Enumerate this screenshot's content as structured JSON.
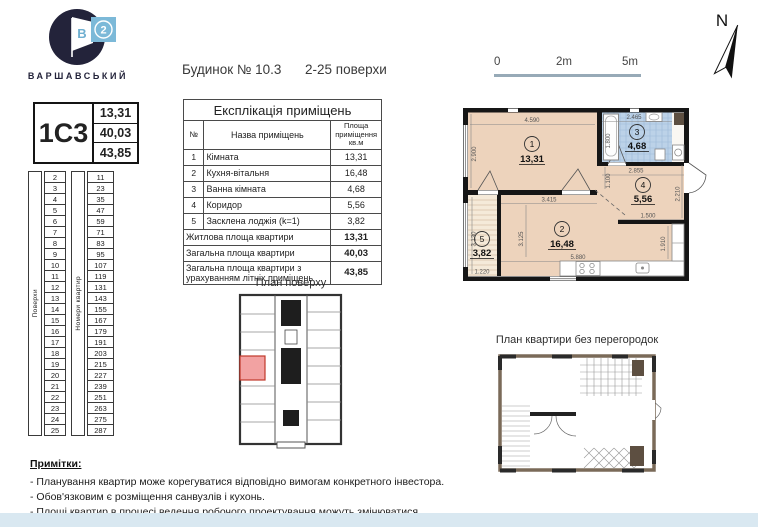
{
  "page": {
    "bottom_strip_color": "#d9e8f1"
  },
  "logo": {
    "brand": "ВАРШАВСЬКИЙ",
    "flag_letter": "В",
    "badge_number": "2"
  },
  "header": {
    "building": "Будинок № 10.3",
    "floors_range": "2-25 поверхи"
  },
  "scale_bar": {
    "labels": [
      "0",
      "2m",
      "5m"
    ]
  },
  "north": {
    "label": "N"
  },
  "unit_card": {
    "code": "1C3",
    "values": [
      "13,31",
      "40,03",
      "43,85"
    ]
  },
  "floors_table": {
    "col1_label": "Поверхи",
    "col2_label": "Номери квартир",
    "floors": [
      2,
      3,
      4,
      5,
      6,
      7,
      8,
      9,
      10,
      11,
      12,
      13,
      14,
      15,
      16,
      17,
      18,
      19,
      20,
      21,
      22,
      23,
      24,
      25
    ],
    "apartments": [
      11,
      23,
      35,
      47,
      59,
      71,
      83,
      95,
      107,
      119,
      131,
      143,
      155,
      167,
      179,
      191,
      203,
      215,
      227,
      239,
      251,
      263,
      275,
      287
    ]
  },
  "explication": {
    "title": "Експлікація приміщень",
    "headers": [
      "№",
      "Назва приміщень",
      "Площа приміщення кв.м"
    ],
    "rows": [
      [
        "1",
        "Кімната",
        "13,31"
      ],
      [
        "2",
        "Кухня-вітальня",
        "16,48"
      ],
      [
        "3",
        "Ванна кімната",
        "4,68"
      ],
      [
        "4",
        "Коридор",
        "5,56"
      ],
      [
        "5",
        "Засклена лоджія (k=1)",
        "3,82"
      ]
    ],
    "summary": [
      {
        "label": "Житлова площа квартири",
        "value": "13,31"
      },
      {
        "label": "Загальна площа квартири",
        "value": "40,03"
      },
      {
        "label": "Загальна площа квартири з урахуванням літніх приміщень",
        "value": "43,85"
      }
    ]
  },
  "floor_plan": {
    "title": "План поверху",
    "highlight_color": "#f2a2a2"
  },
  "apartment_plan": {
    "room_fill": "#edd3bc",
    "bath_fill": "#bcd2e8",
    "loggia_fill": "#f5ead9",
    "rooms": {
      "r1": {
        "num": "1",
        "area": "13,31"
      },
      "r2": {
        "num": "2",
        "area": "16,48"
      },
      "r3": {
        "num": "3",
        "area": "4,68"
      },
      "r4": {
        "num": "4",
        "area": "5,56"
      },
      "r5": {
        "num": "5",
        "area": "3,82"
      }
    },
    "dims": {
      "room1_w": "4.590",
      "room1_h": "2.900",
      "bath_w": "2.465",
      "bath_tub": "1.800",
      "hall_w": "2.855",
      "hall_open": "1.100",
      "entry_side": "2.210",
      "hall_w2": "1.500",
      "room2_w1": "3.415",
      "room2_h": "3.125",
      "room2_w": "5.880",
      "kitchen_side": "1.910",
      "loggia_w": "1.220",
      "loggia_h": "3.130"
    }
  },
  "no_partition_plan": {
    "title": "План квартири без перегородок"
  },
  "notes": {
    "title": "Примітки:",
    "items": [
      "- Планування квартир може корегуватися відповідно вимогам конкретного інвестора.",
      "- Обов'язковим є розміщення санвузлів і кухонь.",
      "- Площі квартир в процесі ведення робочого проектування можуть змінюватися."
    ]
  }
}
